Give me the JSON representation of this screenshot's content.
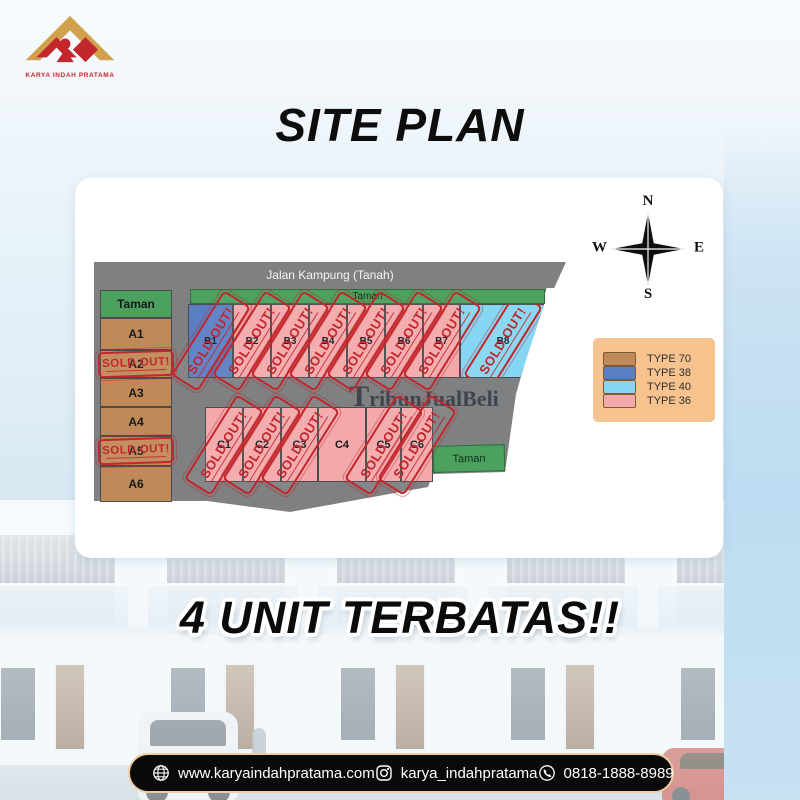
{
  "brand": {
    "name": "KARYA INDAH PRATAMA"
  },
  "page_title": "SITE PLAN",
  "tagline": "4 UNIT TERBATAS!!",
  "watermark": "TribunJualBeli",
  "compass": {
    "north": "N",
    "east": "E",
    "south": "S",
    "west": "W"
  },
  "legend": {
    "items": [
      {
        "label": "TYPE 70",
        "color": "#c08a58"
      },
      {
        "label": "TYPE 38",
        "color": "#5b7ec2"
      },
      {
        "label": "TYPE 40",
        "color": "#85d6f3"
      },
      {
        "label": "TYPE 36",
        "color": "#f3a9ab"
      }
    ]
  },
  "site_plan": {
    "road_label": "Jalan Kampung (Tanah)",
    "park_label": "Taman",
    "sold_stamp": "SOLD OUT!",
    "a_column": [
      {
        "label": "Taman",
        "park": true
      },
      {
        "label": "A1",
        "type": "70",
        "sold": false
      },
      {
        "label": "A2",
        "type": "70",
        "sold": true
      },
      {
        "label": "A3",
        "type": "70",
        "sold": false
      },
      {
        "label": "A4",
        "type": "70",
        "sold": false
      },
      {
        "label": "A5",
        "type": "70",
        "sold": true
      },
      {
        "label": "A6",
        "type": "70",
        "sold": false
      }
    ],
    "b_row": [
      {
        "label": "B1",
        "type": "38",
        "sold": true
      },
      {
        "label": "B2",
        "type": "36",
        "sold": true
      },
      {
        "label": "B3",
        "type": "36",
        "sold": true
      },
      {
        "label": "B4",
        "type": "36",
        "sold": true
      },
      {
        "label": "B5",
        "type": "36",
        "sold": true
      },
      {
        "label": "B6",
        "type": "36",
        "sold": true
      },
      {
        "label": "B7",
        "type": "36",
        "sold": true
      },
      {
        "label": "B8",
        "type": "40",
        "sold": true
      }
    ],
    "c_row": [
      {
        "label": "C1",
        "type": "36",
        "sold": true
      },
      {
        "label": "C2",
        "type": "36",
        "sold": true
      },
      {
        "label": "C3",
        "type": "36",
        "sold": true
      },
      {
        "label": "C4",
        "type": "36",
        "sold": false
      },
      {
        "label": "C5",
        "type": "36",
        "sold": true
      },
      {
        "label": "C6",
        "type": "36",
        "sold": true
      }
    ]
  },
  "footer": {
    "website": "www.karyaindahpratama.com",
    "instagram": "karya_indahpratama",
    "phone": "0818-1888-8989"
  },
  "colors": {
    "stamp": "#c1272d",
    "road": "#7e8082",
    "park": "#4ba15d",
    "legend_bg": "#f6c28e",
    "types": {
      "70": "#c08a58",
      "38": "#5b7ec2",
      "40": "#85d6f3",
      "36": "#f3a9ab"
    }
  }
}
